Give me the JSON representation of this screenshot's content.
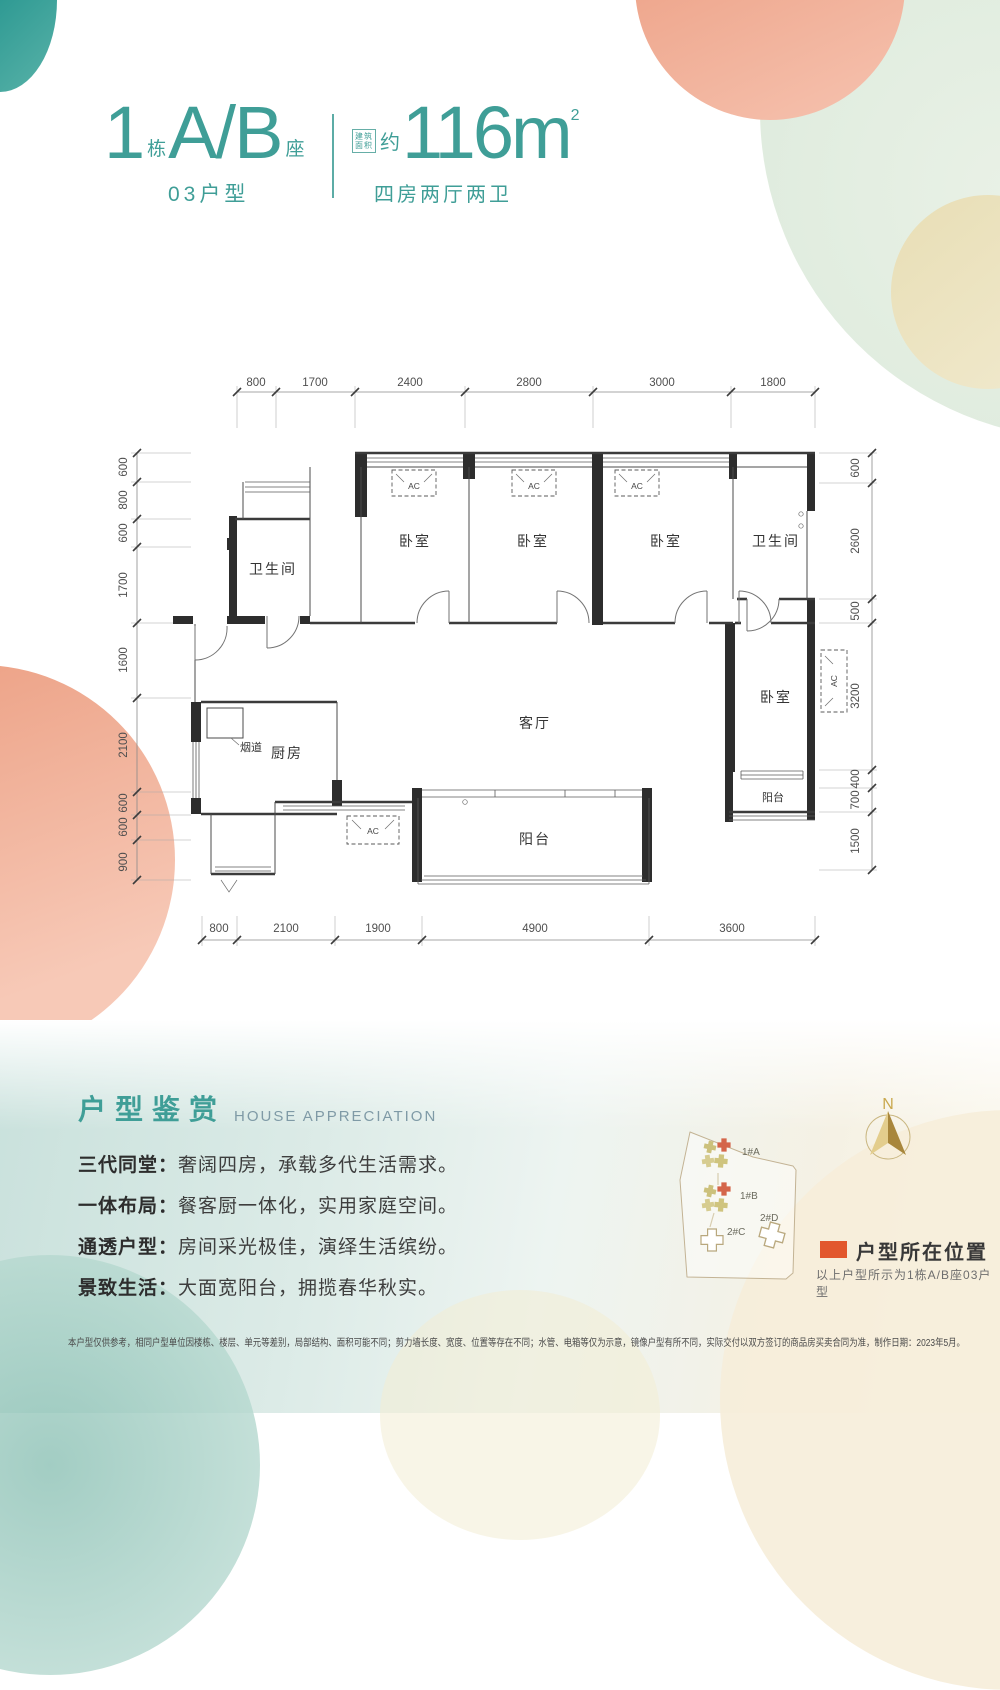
{
  "header": {
    "block_number": "1",
    "block_number_unit": "栋",
    "block_letters": "A/B",
    "block_letters_unit": "座",
    "unit_type": "03户型",
    "area_seal_line1": "建筑",
    "area_seal_line2": "面积",
    "area_approx": "约",
    "area_value": "116m",
    "area_exponent": "2",
    "layout_desc": "四房两厅两卫"
  },
  "floorplan": {
    "dims_top": [
      "800",
      "1700",
      "2400",
      "2800",
      "3000",
      "1800"
    ],
    "dims_bottom": [
      "800",
      "2100",
      "1900",
      "4900",
      "3600"
    ],
    "dims_left": [
      "600",
      "800",
      "600",
      "1700",
      "1600",
      "2100",
      "600",
      "600",
      "900"
    ],
    "dims_right": [
      "600",
      "2600",
      "500",
      "3200",
      "400",
      "700",
      "1500"
    ],
    "rooms": {
      "bedroom1": "卧室",
      "bedroom2": "卧室",
      "bedroom3": "卧室",
      "bedroom4": "卧室",
      "bath_left": "卫生间",
      "bath_right": "卫生间",
      "kitchen": "厨房",
      "flue": "烟道",
      "living": "客厅",
      "balcony_main": "阳台",
      "balcony_side": "阳台"
    },
    "ac_label": "AC"
  },
  "appreciation": {
    "title_cn": "户型鉴赏",
    "title_en": "HOUSE APPRECIATION",
    "points": [
      {
        "label": "三代同堂：",
        "text": "奢阔四房，承载多代生活需求。"
      },
      {
        "label": "一体布局：",
        "text": "餐客厨一体化，实用家庭空间。"
      },
      {
        "label": "通透户型：",
        "text": "房间采光极佳，演绎生活缤纷。"
      },
      {
        "label": "景致生活：",
        "text": "大面宽阳台，拥揽春华秋实。"
      }
    ]
  },
  "sitemap": {
    "compass_label": "N",
    "buildings": [
      {
        "label": "1#A"
      },
      {
        "label": "1#B"
      },
      {
        "label": "2#C"
      },
      {
        "label": "2#D"
      }
    ],
    "legend_label": "户型所在位置",
    "legend_note": "以上户型所示为1栋A/B座03户型",
    "highlight_color": "#e2572d"
  },
  "disclaimer": "本户型仅供参考，相同户型单位因楼栋、楼层、单元等差别，局部结构、面积可能不同；剪力墙长度、宽度、位置等存在不同；水管、电箱等仅为示意，镜像户型有所不同，实际交付以双方签订的商品房买卖合同为准，制作日期：2023年5月。"
}
